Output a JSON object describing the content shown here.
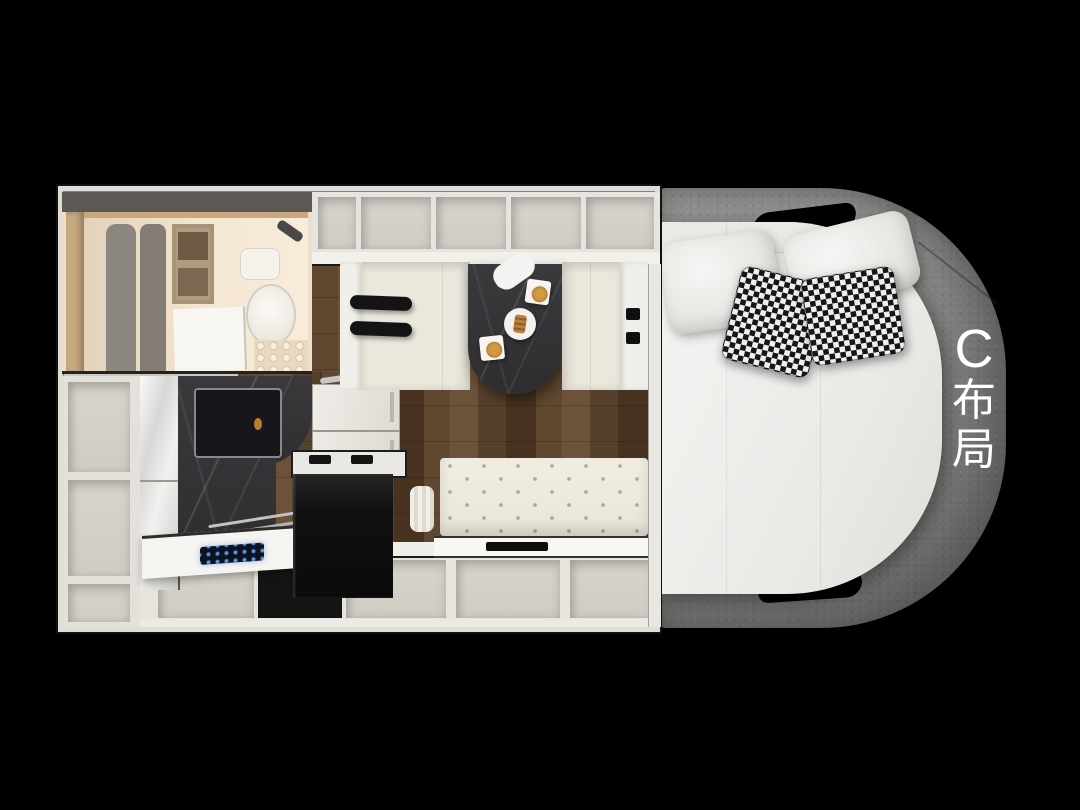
{
  "scene": {
    "description": "Top-down 3D rendered floor plan of a camper van (RV) interior on a black background",
    "background_color": "#000000",
    "layout_label": {
      "text": "C布局",
      "chars": [
        "C",
        "布",
        "局"
      ],
      "color": "#ffffff"
    }
  },
  "regions": {
    "bathroom": "wet bath with toilet, shower screen and shelving",
    "overhead_cabinets": "row of open overhead storage cubbies",
    "left_shelving": "column of open shelf cubbies",
    "kitchen": "kitchen block with glossy fridge, dark marble tower sink, counter and control panel",
    "oven": "black built-in appliance below a trimmed counter",
    "dinette": "two facing cream benches with dark marble table set with coffee cups and pastry",
    "sofa": "tufted cream bench with glossy seat and storage cubbies",
    "bed": "rear island bed with grey fabric surround, white mattress, pillows and layout label"
  },
  "colors": {
    "cabinet_light": "#e7e4dd",
    "wood_floor": "#5f4730",
    "marble_dark": "#343236",
    "bed_surround_grey": "#8d8c8a",
    "mattress_white": "#ededeb",
    "bench_cream": "#eae7dc",
    "coffee_accent": "#d29a43",
    "control_panel_blue": "#5d93e8"
  }
}
